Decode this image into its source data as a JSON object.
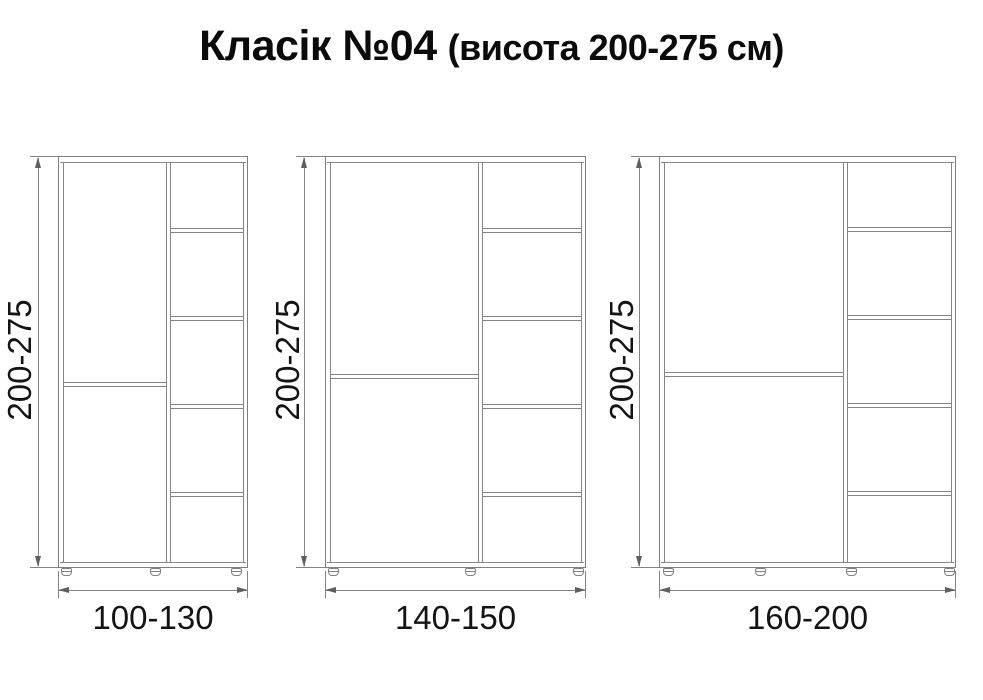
{
  "title": {
    "main": "Класік №04",
    "sub": "(висота 200-275 см)"
  },
  "units": "см",
  "cabinets": [
    {
      "height_label": "200-275",
      "width_label": "100-130",
      "door_sections": 2,
      "shelf_compartments": 5,
      "feet": 3
    },
    {
      "height_label": "200-275",
      "width_label": "140-150",
      "door_sections": 2,
      "shelf_compartments": 5,
      "feet": 3
    },
    {
      "height_label": "200-275",
      "width_label": "160-200",
      "door_sections": 2,
      "shelf_compartments": 5,
      "feet": 4
    }
  ],
  "colors": {
    "background": "#ffffff",
    "line": "#848484",
    "arrow": "#5f5f5f",
    "text": "#141414",
    "title_text": "#0b0b0b"
  }
}
